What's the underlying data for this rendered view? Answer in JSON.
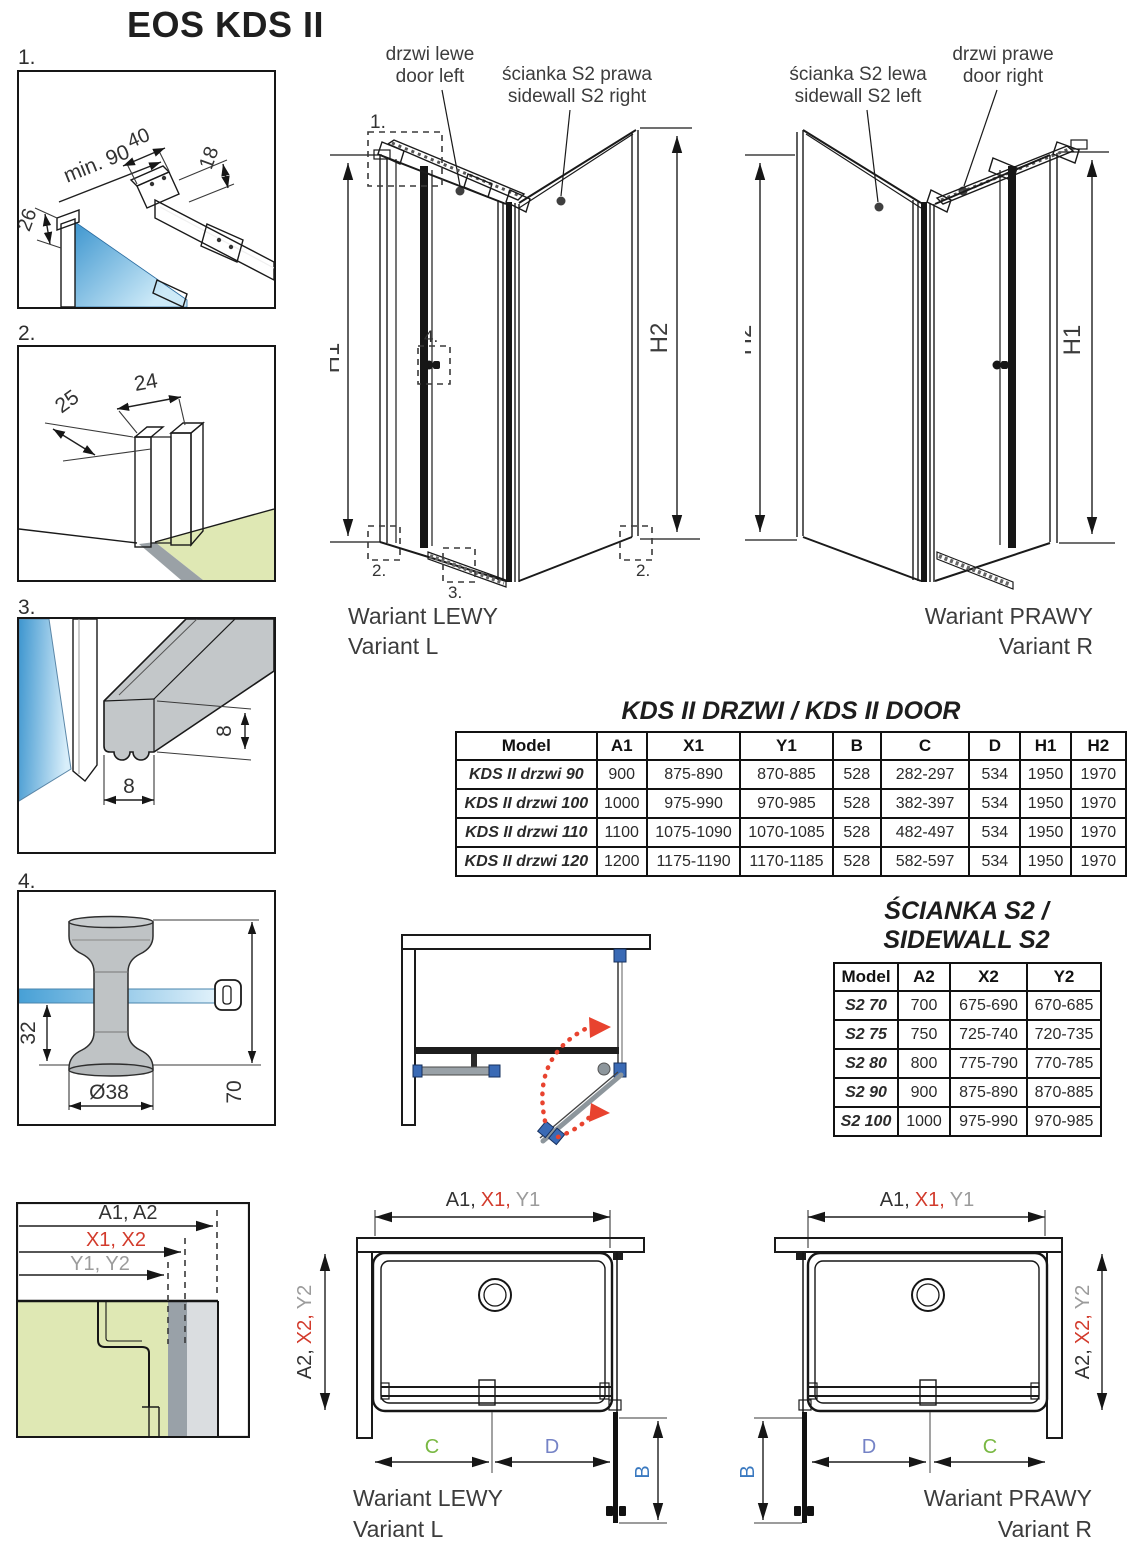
{
  "page_title": "EOS KDS II",
  "colors": {
    "accent_red": "#d23b2c",
    "label_gray": "#9b9b9b",
    "dim_green": "#79b843",
    "dim_blue": "#3a79c0",
    "dim_purple": "#5b50a5",
    "swing_arrow_red": "#e8432f",
    "fitting_blue": "#3a6ab5",
    "glass_blue": "#3e96cf",
    "floor_green": "#dfe8b4"
  },
  "details": {
    "d1": {
      "label": "1.",
      "dim_min_width": "min. 90",
      "dim_bar": "40",
      "dim_height": "18",
      "dim_offset": "26"
    },
    "d2": {
      "label": "2.",
      "dim_depth": "25",
      "dim_width": "24"
    },
    "d3": {
      "label": "3.",
      "dim_height": "8",
      "dim_width": "8"
    },
    "d4": {
      "label": "4.",
      "dim_inset": "32",
      "dim_diameter": "Ø38",
      "dim_height": "70"
    }
  },
  "iso_left": {
    "door_label_pl": "drzwi lewe",
    "door_label_en": "door left",
    "sidewall_label_pl": "ścianka S2 prawa",
    "sidewall_label_en": "sidewall S2 right",
    "dim_left": "H1",
    "dim_right": "H2",
    "ref_1": "1.",
    "ref_2a": "2.",
    "ref_2b": "2.",
    "ref_3": "3.",
    "ref_4": "4.",
    "caption_pl": "Wariant LEWY",
    "caption_en": "Variant L"
  },
  "iso_right": {
    "sidewall_label_pl": "ścianka S2 lewa",
    "sidewall_label_en": "sidewall S2 left",
    "door_label_pl": "drzwi prawe",
    "door_label_en": "door right",
    "dim_left": "H2",
    "dim_right": "H1",
    "caption_pl": "Wariant PRAWY",
    "caption_en": "Variant R"
  },
  "door_table": {
    "title": "KDS II DRZWI /  KDS II DOOR",
    "headers": [
      "Model",
      "A1",
      "X1",
      "Y1",
      "B",
      "C",
      "D",
      "H1",
      "H2"
    ],
    "rows": [
      [
        "KDS II drzwi 90",
        "900",
        "875-890",
        "870-885",
        "528",
        "282-297",
        "534",
        "1950",
        "1970"
      ],
      [
        "KDS II drzwi 100",
        "1000",
        "975-990",
        "970-985",
        "528",
        "382-397",
        "534",
        "1950",
        "1970"
      ],
      [
        "KDS II drzwi 110",
        "1100",
        "1075-1090",
        "1070-1085",
        "528",
        "482-497",
        "534",
        "1950",
        "1970"
      ],
      [
        "KDS II drzwi 120",
        "1200",
        "1175-1190",
        "1170-1185",
        "528",
        "582-597",
        "534",
        "1950",
        "1970"
      ]
    ]
  },
  "sidewall_table": {
    "title_line1": "ŚCIANKA S2 /",
    "title_line2": "SIDEWALL S2",
    "headers": [
      "Model",
      "A2",
      "X2",
      "Y2"
    ],
    "rows": [
      [
        "S2 70",
        "700",
        "675-690",
        "670-685"
      ],
      [
        "S2 75",
        "750",
        "725-740",
        "720-735"
      ],
      [
        "S2 80",
        "800",
        "775-790",
        "770-785"
      ],
      [
        "S2 90",
        "900",
        "875-890",
        "870-885"
      ],
      [
        "S2 100",
        "1000",
        "975-990",
        "970-985"
      ]
    ]
  },
  "corner_detail": {
    "dim_a": "A1, A2",
    "dim_x": "X1, X2",
    "dim_y": "Y1, Y2"
  },
  "plan_left": {
    "width_a": "A1,",
    "width_x": "X1,",
    "width_y": "Y1",
    "depth_a": "A2,",
    "depth_x": "X2,",
    "depth_y": "Y2",
    "dim_b": "B",
    "dim_c": "C",
    "dim_d": "D",
    "caption_pl": "Wariant LEWY",
    "caption_en": "Variant L"
  },
  "plan_right": {
    "width_a": "A1,",
    "width_x": "X1,",
    "width_y": "Y1",
    "depth_a": "A2,",
    "depth_x": "X2,",
    "depth_y": "Y2",
    "dim_b": "B",
    "dim_c": "C",
    "dim_d": "D",
    "caption_pl": "Wariant PRAWY",
    "caption_en": "Variant R"
  }
}
